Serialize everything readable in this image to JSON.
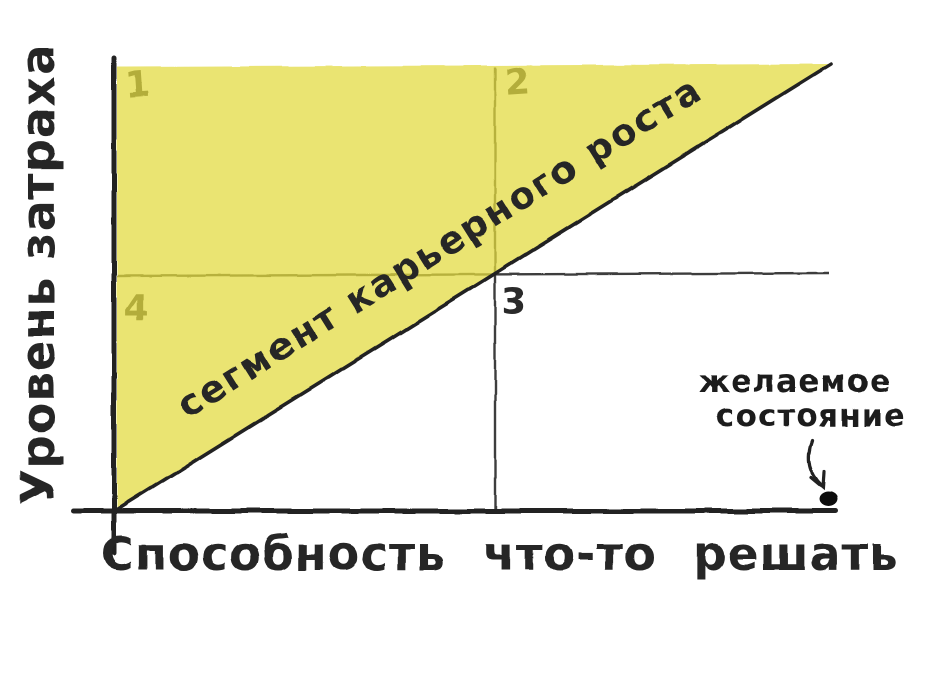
{
  "chart_data": {
    "type": "area",
    "style": "hand-drawn marker sketch, quadrant diagram",
    "title": "",
    "xlabel": "Способность что-то решать",
    "ylabel": "Уровень затраха",
    "axis_ranges": {
      "x": [
        0,
        1
      ],
      "y": [
        0,
        1
      ]
    },
    "grid": false,
    "legend": "none",
    "region": {
      "label": "сегмент карьерного роста",
      "shape": "triangle",
      "vertices_norm": [
        [
          0,
          0
        ],
        [
          0,
          1
        ],
        [
          1,
          1
        ]
      ],
      "description": "highlighted triangle above the diagonal from origin to top-right"
    },
    "diagonal": {
      "from_norm": [
        0,
        0
      ],
      "to_norm": [
        1,
        1
      ]
    },
    "dividers": {
      "x_norm": 0.53,
      "y_norm": 0.52
    },
    "quadrants": [
      {
        "label": "1",
        "position": "top-left"
      },
      {
        "label": "2",
        "position": "top-right"
      },
      {
        "label": "3",
        "position": "bottom-right"
      },
      {
        "label": "4",
        "position": "bottom-left"
      }
    ],
    "annotation": {
      "line1": "желаемое",
      "line2": "состояние",
      "marker": "dot",
      "points_to_norm": [
        0.99,
        0.0
      ]
    }
  },
  "colors": {
    "background": "#ffffff",
    "ink": "#242424",
    "region_fill_apparent": "#eae471",
    "region_fill_rgba": "rgba(227,219,64,0.74)",
    "divider_under_region_apparent": "#8f8c3a"
  }
}
